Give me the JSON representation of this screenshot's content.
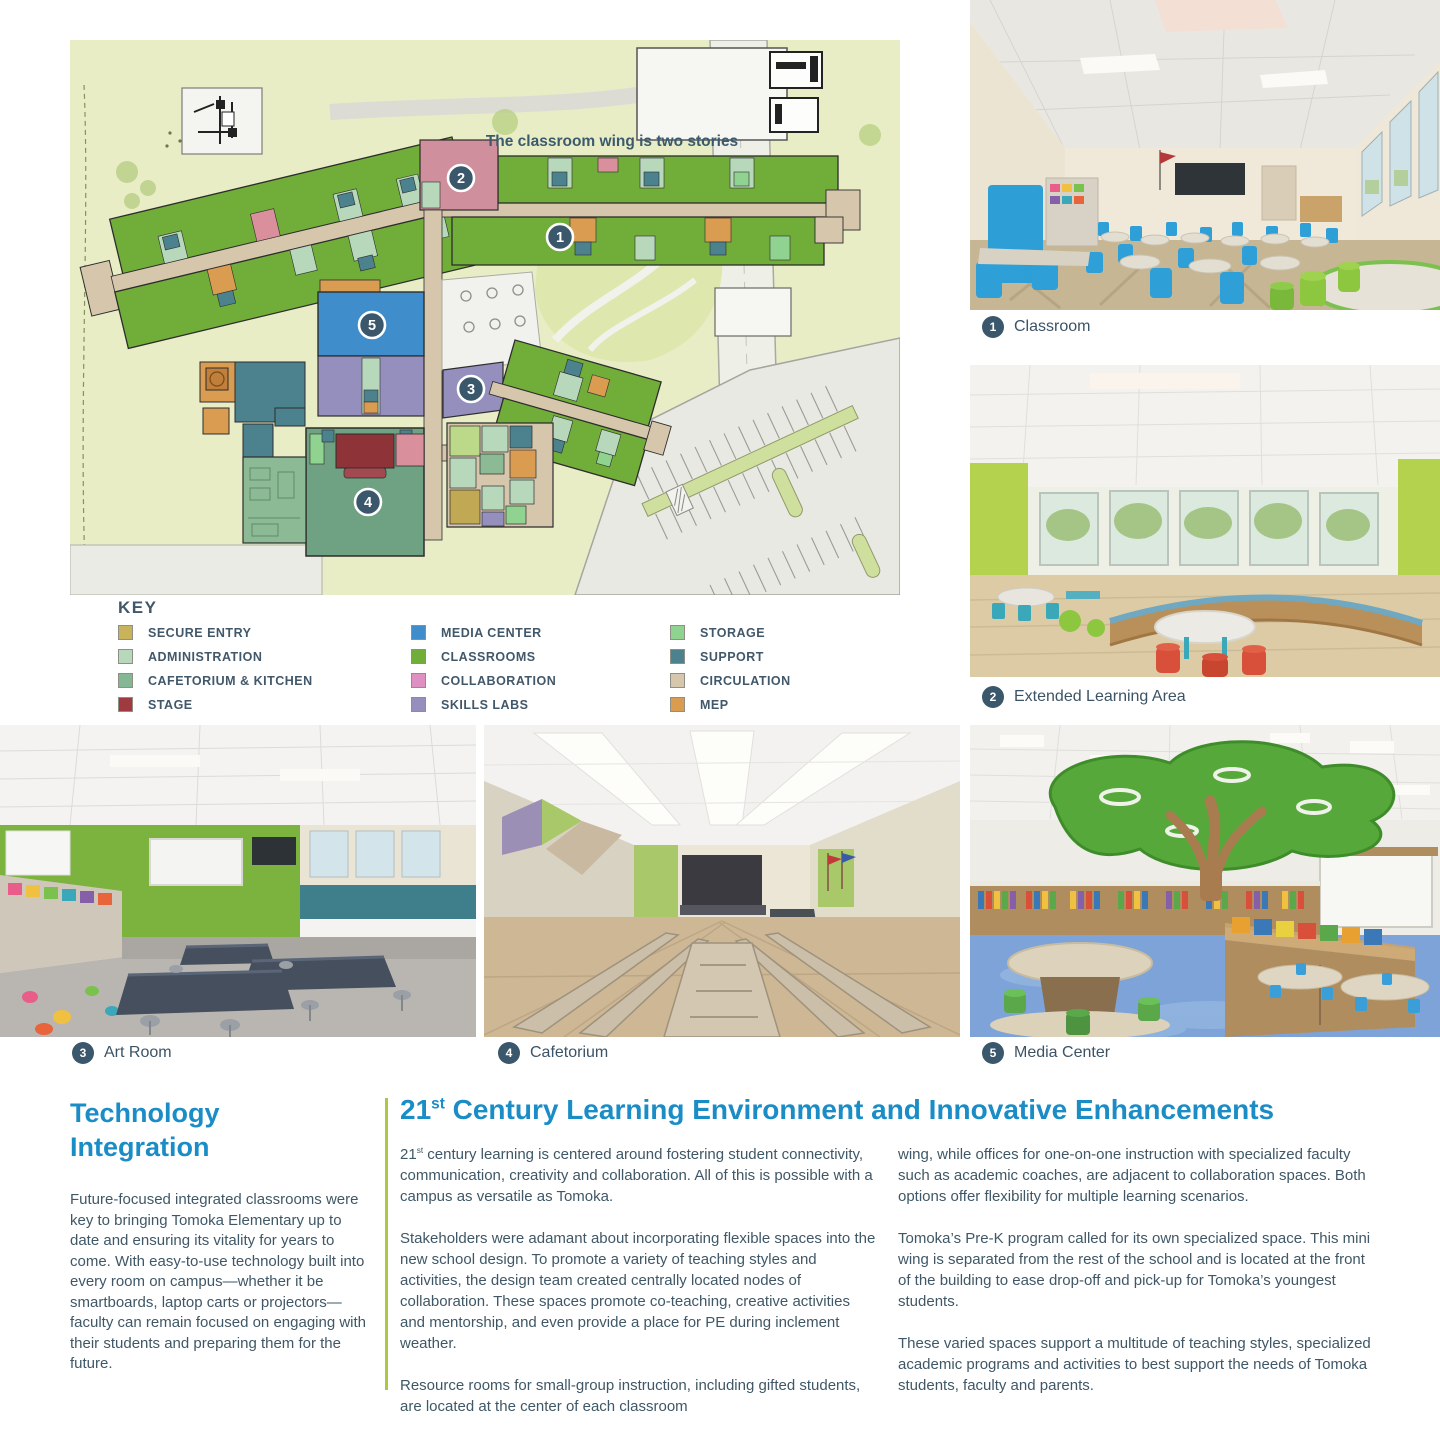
{
  "plan": {
    "annotation": "The classroom wing is two stories",
    "key": {
      "title": "KEY",
      "columns": [
        {
          "items": [
            {
              "label": "SECURE ENTRY",
              "color": "#c9b35a"
            },
            {
              "label": "ADMINISTRATION",
              "color": "#b8d8bc"
            },
            {
              "label": "CAFETORIUM & KITCHEN",
              "color": "#84b894"
            },
            {
              "label": "STAGE",
              "color": "#9e3a40"
            }
          ]
        },
        {
          "items": [
            {
              "label": "MEDIA CENTER",
              "color": "#3f8dcb"
            },
            {
              "label": "CLASSROOMS",
              "color": "#71ad39"
            },
            {
              "label": "COLLABORATION",
              "color": "#df90c3"
            },
            {
              "label": "SKILLS LABS",
              "color": "#958fbd"
            }
          ]
        },
        {
          "items": [
            {
              "label": "STORAGE",
              "color": "#90d290"
            },
            {
              "label": "SUPPORT",
              "color": "#4b828e"
            },
            {
              "label": "CIRCULATION",
              "color": "#d6c6ac"
            },
            {
              "label": "MEP",
              "color": "#da9c50"
            }
          ]
        }
      ]
    }
  },
  "photos": {
    "captions": [
      {
        "num": "1",
        "label": "Classroom"
      },
      {
        "num": "2",
        "label": "Extended Learning Area"
      },
      {
        "num": "3",
        "label": "Art Room"
      },
      {
        "num": "4",
        "label": "Cafetorium"
      },
      {
        "num": "5",
        "label": "Media Center"
      }
    ]
  },
  "tech": {
    "heading": "Technology Integration",
    "body": "Future-focused integrated classrooms were key to bringing Tomoka Elementary up to date and ensuring its vitality for years to come. With easy-to-use technology built into every room on campus—whether it be smartboards, laptop carts or projectors—faculty can remain focused on engaging with their students and preparing them for the future."
  },
  "main": {
    "heading_num": "21",
    "heading_sup": "st",
    "heading_rest": " Century Learning Environment and Innovative Enhancements",
    "col1": {
      "p1_num": "21",
      "p1_sup": "st",
      "p1_rest": " century learning is centered around fostering student connectivity, communication, creativity and collaboration. All of this is possible with a campus as versatile as Tomoka.",
      "p2": "Stakeholders were adamant about incorporating flexible spaces into the new school design. To promote a variety of teaching styles and activities, the design team created centrally located nodes of collaboration. These spaces promote co-teaching, creative activities and mentorship, and even provide a place for PE during inclement weather.",
      "p3": "Resource rooms for small-group instruction, including gifted students, are located at the center of each classroom"
    },
    "col2": {
      "p1": "wing, while offices for one-on-one instruction with specialized faculty such as academic coaches, are adjacent to collaboration spaces. Both options offer flexibility for multiple learning scenarios.",
      "p2": "Tomoka’s Pre-K program called for its own specialized space. This mini wing is separated from the rest of the school and is located at the front of the building to ease drop-off and pick-up for Tomoka’s youngest students.",
      "p3": "These varied spaces support a multitude of teaching styles, specialized academic programs and activities to best support the needs of Tomoka students, faculty and parents."
    }
  },
  "colors": {
    "accent_blue": "#1b8dc6",
    "body_text": "#3f5766",
    "badge": "#3a576b",
    "divider_green": "#a9c93f"
  }
}
